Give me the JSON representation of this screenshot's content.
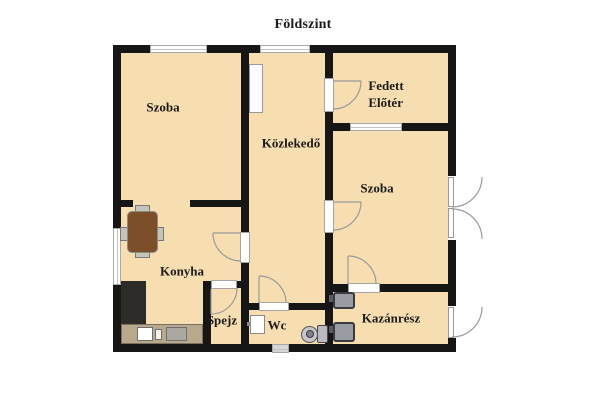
{
  "title": "Földszint",
  "rooms": {
    "szoba_top_left": {
      "label": "Szoba"
    },
    "kozlekedo": {
      "label": "Közlekedő"
    },
    "fedett_eloter": {
      "label": "Fedett\nElőtér"
    },
    "szoba_right": {
      "label": "Szoba"
    },
    "konyha": {
      "label": "Konyha"
    },
    "spejz": {
      "label": "Spejz"
    },
    "wc": {
      "label": "Wc"
    },
    "kazanresz": {
      "label": "Kazánrész"
    }
  },
  "furniture": {
    "hall_cabinet": "cabinet",
    "dining_table": "dining-table",
    "chairs": "chair",
    "counter_dark": "kitchen-counter",
    "counter_light": "kitchen-worktop",
    "kitchen_sink": "kitchen-sink",
    "wc_basin": "hand-basin",
    "toilet": "toilet",
    "boilers": "boiler-radiator",
    "vent": "bottom-vent-window"
  },
  "colors": {
    "floor": "#f6deb1",
    "wall": "#161616",
    "window-frame": "#a8a8a8",
    "door-line": "#9a9a9a",
    "table": "#7c4e2a",
    "counter-dark": "#2d2c28",
    "counter-light": "#b9a98c",
    "fixture": "#9b9ba3",
    "label": "#1b1b1b"
  }
}
